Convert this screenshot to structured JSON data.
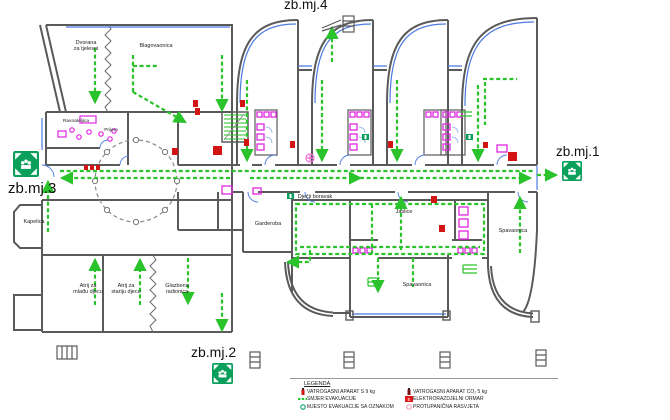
{
  "title": "Evakuacijski plan - tlocrt",
  "assembly_points": {
    "top": "zb.mj.4",
    "right": "zb.mj.1",
    "left": "zb.mj.3",
    "bottom": "zb.mj.2"
  },
  "rooms": {
    "dvorana": "Dvorana\nza tjelesni",
    "blagovaonica": "Blagovaonica",
    "ravnateljica": "Ravnateljica",
    "prijem": "Prijem",
    "kapelica": "Kapelica",
    "atrij_mladja": "Atrij za\nmlađu djecu",
    "atrij_starija": "Atrij za\nstariju djecu",
    "glazbena": "Glazbena\nradionica",
    "djecji_boravak": "Dječji boravak",
    "garderoba": "Garderoba",
    "jaslice": "Jaslice",
    "spavaonica_desno": "Spavaonica",
    "spavaonica_dolje": "Spavaonica"
  },
  "legend": {
    "title": "LEGENDA",
    "items_left": [
      {
        "icon": "fire-extinguisher-s9-icon",
        "label": "VATROGASNI APARAT S 9 kg"
      },
      {
        "icon": "evacuation-direction-icon",
        "label": "SMJER EVAKUACIJE"
      },
      {
        "icon": "evacuation-point-icon",
        "label": "MJESTO EVAKUACIJE SA OZNAKOM"
      }
    ],
    "items_right": [
      {
        "icon": "fire-extinguisher-co2-icon",
        "label": "VATROGASNI APARAT CO₂ 5 kg"
      },
      {
        "icon": "electrical-cabinet-icon",
        "label": "ELEKTRORAZDJELNI ORMAR"
      },
      {
        "icon": "anti-panic-light-icon",
        "label": "PROTUPANIČNA RASVJETA"
      }
    ]
  },
  "colors": {
    "wall": "#5a5a5a",
    "evacuation_green": "#2bc32b",
    "assembly_green": "#0aa05c",
    "fire_red": "#d21414",
    "fixture_magenta": "#e127e1",
    "window_blue": "#4a7ae0"
  }
}
